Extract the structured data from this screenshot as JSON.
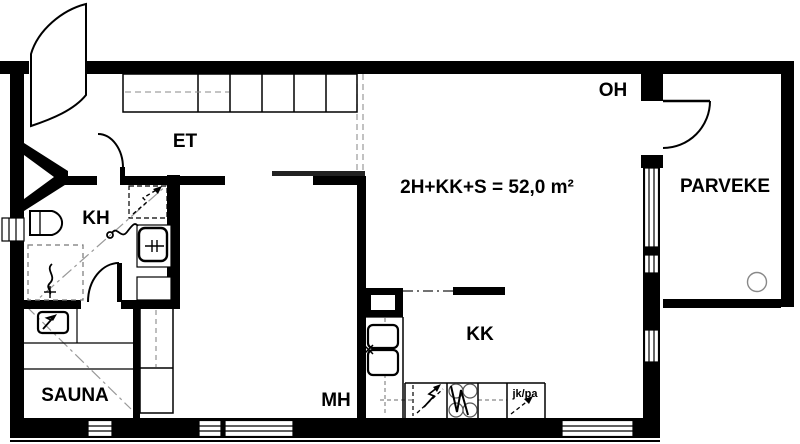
{
  "floorplan": {
    "title": "2H+KK+S = 52,0 m²",
    "rooms": {
      "et": {
        "label": "ET"
      },
      "kh": {
        "label": "KH"
      },
      "sauna": {
        "label": "SAUNA"
      },
      "mh": {
        "label": "MH"
      },
      "kk": {
        "label": "KK"
      },
      "oh": {
        "label": "OH"
      },
      "parveke": {
        "label": "PARVEKE"
      }
    },
    "appliances": {
      "fridge_freezer": {
        "label": "jk/pa"
      }
    },
    "colors": {
      "wall": "#000000",
      "background": "#ffffff",
      "dashed_guide": "#999999"
    }
  }
}
